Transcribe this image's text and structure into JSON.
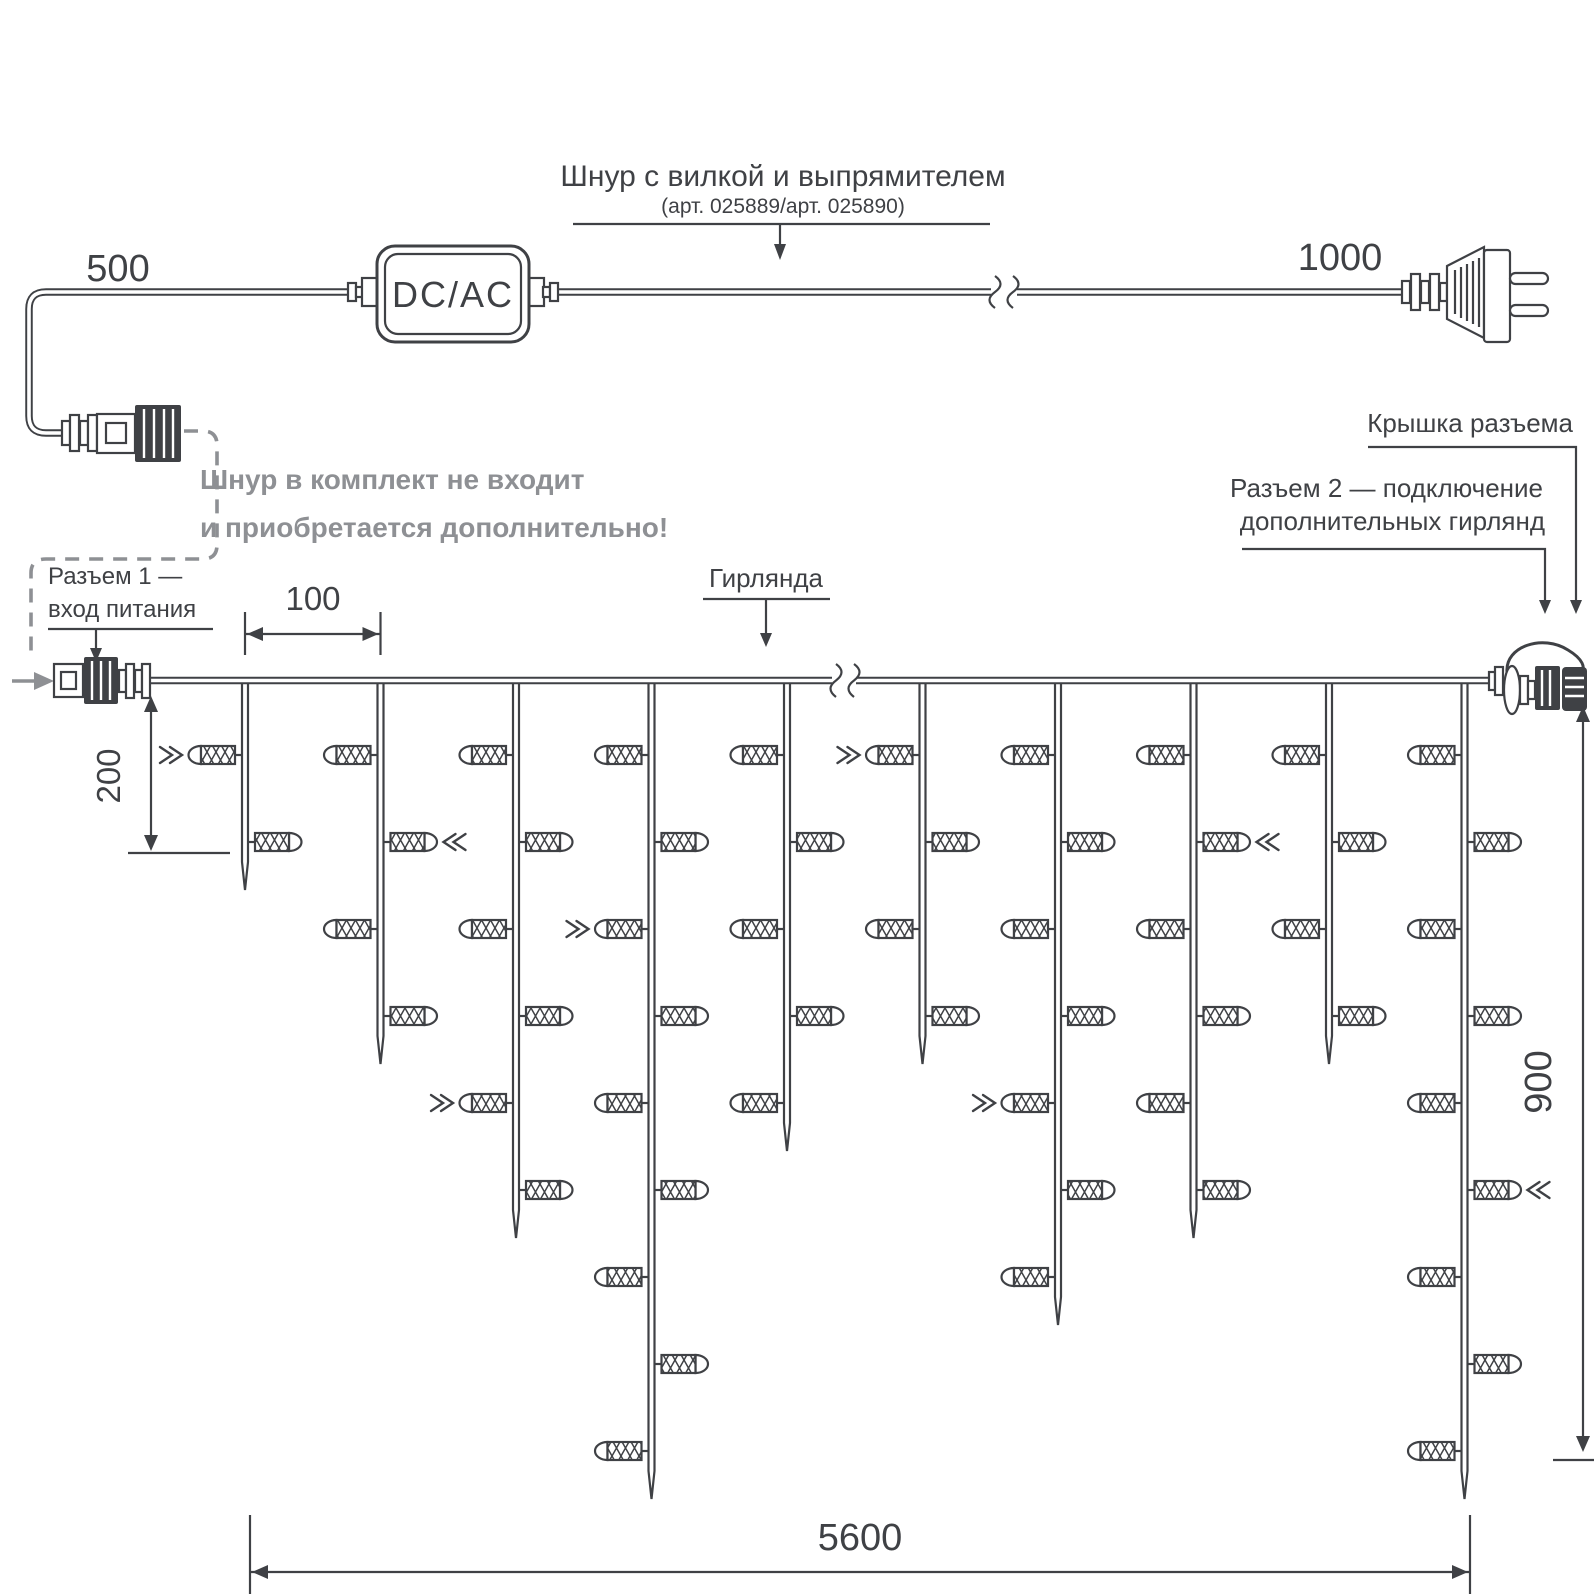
{
  "diagram": {
    "cord": {
      "title": "Шнур с вилкой и выпрямителем",
      "subtitle": "(арт. 025889/арт. 025890)",
      "converter_label": "DC/AC",
      "length_left": "500",
      "length_right": "1000"
    },
    "note": {
      "line1": "Шнур в комплект не входит",
      "line2": "и приобретается дополнительно!"
    },
    "labels": {
      "connector1_line1": "Разъем 1 —",
      "connector1_line2": "вход питания",
      "garland": "Гирлянда",
      "cap": "Крышка разъема",
      "connector2_line1": "Разъем 2 — подключение",
      "connector2_line2": "дополнительных гирлянд"
    },
    "dimensions": {
      "drop_spacing": "100",
      "first_drop_length": "200",
      "garland_height": "900",
      "garland_width": "5600"
    },
    "colors": {
      "line": "#3f4145",
      "muted": "#8e9094"
    },
    "garland": {
      "wire_y": 680.5,
      "first_drop_x": 245,
      "drop_step_x": 135.5,
      "first_bulb_y": 755,
      "bulb_step_y": 87,
      "bulbs_per_drop": [
        2,
        4,
        6,
        9,
        5,
        4,
        7,
        6,
        4,
        9
      ],
      "light_arrows": [
        [
          1,
          1
        ],
        [
          2,
          2
        ],
        [
          3,
          5
        ],
        [
          4,
          3
        ],
        [
          6,
          1
        ],
        [
          7,
          5
        ],
        [
          8,
          2
        ],
        [
          10,
          6
        ]
      ]
    }
  }
}
